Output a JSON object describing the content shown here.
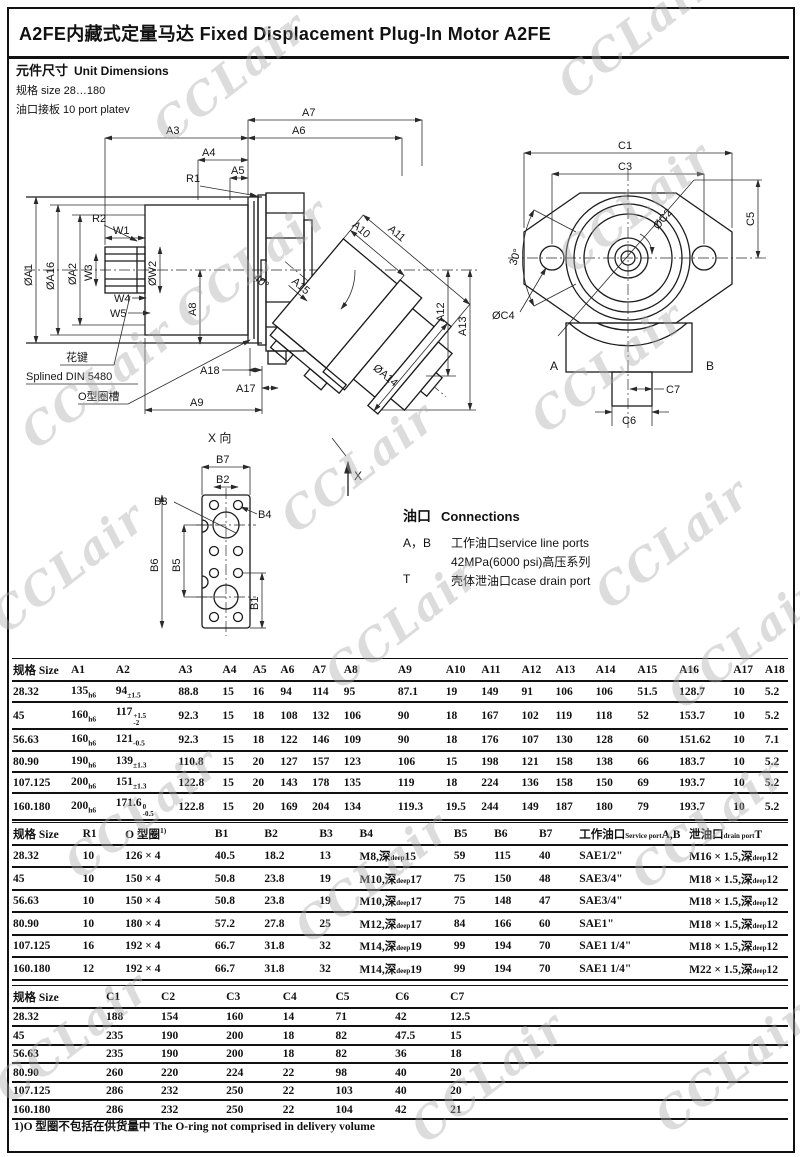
{
  "title": "A2FE内藏式定量马达  Fixed Displacement Plug-In Motor A2FE",
  "section": {
    "heading_zh": "元件尺寸",
    "heading_en": "Unit Dimensions",
    "size_line": "规格 size 28…180",
    "port_line": "油口接板 10 port platev"
  },
  "watermark": {
    "text": "CCLair"
  },
  "connections": {
    "heading_zh": "油口",
    "heading_en": "Connections",
    "rows": [
      {
        "label": "A，B",
        "text": "工作油口service line ports"
      },
      {
        "label": "",
        "text": "42MPa(6000 psi)高压系列"
      },
      {
        "label": "T",
        "text": "壳体泄油口case drain port"
      }
    ]
  },
  "dims": {
    "a3": "A3",
    "a4": "A4",
    "a5": "A5",
    "a6": "A6",
    "a7": "A7",
    "a8": "A8",
    "a9": "A9",
    "a10": "A10",
    "a11": "A11",
    "a12": "A12",
    "a13": "A13",
    "a15": "A15",
    "a17": "A17",
    "a18": "A18",
    "r1": "R1",
    "r2": "R2",
    "w1": "W1",
    "w3": "W3",
    "w4": "W4",
    "w5": "W5",
    "phi_a1": "ØA1",
    "phi_a16": "ØA16",
    "phi_a2": "ØA2",
    "phi_w2": "ØW2",
    "phi_a14": "ØA14",
    "deg40": "40°",
    "spline_zh": "花键",
    "spline_en": "Splined DIN 5480",
    "oring_zh": "O型圈槽",
    "x_label": "X",
    "xview": "X 向",
    "b1": "B1",
    "b2": "B2",
    "b3": "B3",
    "b4": "B4",
    "b5": "B5",
    "b6": "B6",
    "b7": "B7",
    "c1": "C1",
    "c3": "C3",
    "phi_c2": "ØC2",
    "c5": "C5",
    "deg30": "30°",
    "phi_c4": "ØC4",
    "port_a": "A",
    "port_b": "B",
    "c6": "C6",
    "c7": "C7"
  },
  "tables": {
    "t1": {
      "headers": [
        "规格 Size",
        "A1",
        "A2",
        "A3",
        "A4",
        "A5",
        "A6",
        "A7",
        "A8",
        "A9",
        "A10",
        "A11",
        "A12",
        "A13",
        "A14",
        "A15",
        "A16",
        "A17",
        "A18"
      ],
      "rows": [
        [
          "28.32",
          {
            "v": "135",
            "sub": "h6"
          },
          {
            "v": "94",
            "sub": "±1.5"
          },
          "88.8",
          "15",
          "16",
          "94",
          "114",
          "95",
          "87.1",
          "19",
          "149",
          "91",
          "106",
          "106",
          "51.5",
          "128.7",
          "10",
          "5.2"
        ],
        [
          "45",
          {
            "v": "160",
            "sub": "h6"
          },
          {
            "v": "117",
            "sup": "+1.5",
            "sub": "-2"
          },
          "92.3",
          "15",
          "18",
          "108",
          "132",
          "106",
          "90",
          "18",
          "167",
          "102",
          "119",
          "118",
          "52",
          "153.7",
          "10",
          "5.2"
        ],
        [
          "56.63",
          {
            "v": "160",
            "sub": "h6"
          },
          {
            "v": "121",
            "sub": "-0.5"
          },
          "92.3",
          "15",
          "18",
          "122",
          "146",
          "109",
          "90",
          "18",
          "176",
          "107",
          "130",
          "128",
          "60",
          "151.62",
          "10",
          "7.1"
        ],
        [
          "80.90",
          {
            "v": "190",
            "sub": "h6"
          },
          {
            "v": "139",
            "sub": "±1.3"
          },
          "110.8",
          "15",
          "20",
          "127",
          "157",
          "123",
          "106",
          "15",
          "198",
          "121",
          "158",
          "138",
          "66",
          "183.7",
          "10",
          "5.2"
        ],
        [
          "107.125",
          {
            "v": "200",
            "sub": "h6"
          },
          {
            "v": "151",
            "sub": "±1.3"
          },
          "122.8",
          "15",
          "20",
          "143",
          "178",
          "135",
          "119",
          "18",
          "224",
          "136",
          "158",
          "150",
          "69",
          "193.7",
          "10",
          "5.2"
        ],
        [
          "160.180",
          {
            "v": "200",
            "sub": "h6"
          },
          {
            "v": "171.6",
            "sup": "0",
            "sub": "-0.5"
          },
          "122.8",
          "15",
          "20",
          "169",
          "204",
          "134",
          "119.3",
          "19.5",
          "244",
          "149",
          "187",
          "180",
          "79",
          "193.7",
          "10",
          "5.2"
        ]
      ]
    },
    "t2": {
      "headers": [
        "规格 Size",
        "R1",
        {
          "v": "O 型圈",
          "sup": "1)"
        },
        "B1",
        "B2",
        "B3",
        "B4",
        "B5",
        "B6",
        "B7",
        {
          "v": "工作油口",
          "small": "Service port",
          "post": "A,B"
        },
        {
          "v": "泄油口",
          "small": "drain port",
          "post": "T"
        }
      ],
      "rows": [
        [
          "28.32",
          "10",
          "126 × 4",
          "40.5",
          "18.2",
          "13",
          {
            "v": "M8,深",
            "small": "deep",
            "post": "15"
          },
          "59",
          "115",
          "40",
          "SAE1/2\"",
          {
            "v": "M16 × 1.5,深",
            "small": "deep",
            "post": "12"
          }
        ],
        [
          "45",
          "10",
          "150 × 4",
          "50.8",
          "23.8",
          "19",
          {
            "v": "M10,深",
            "small": "deep",
            "post": "17"
          },
          "75",
          "150",
          "48",
          "SAE3/4\"",
          {
            "v": "M18 × 1.5,深",
            "small": "deep",
            "post": "12"
          }
        ],
        [
          "56.63",
          "10",
          "150 × 4",
          "50.8",
          "23.8",
          "19",
          {
            "v": "M10,深",
            "small": "deep",
            "post": "17"
          },
          "75",
          "148",
          "47",
          "SAE3/4\"",
          {
            "v": "M18 × 1.5,深",
            "small": "deep",
            "post": "12"
          }
        ],
        [
          "80.90",
          "10",
          "180 × 4",
          "57.2",
          "27.8",
          "25",
          {
            "v": "M12,深",
            "small": "deep",
            "post": "17"
          },
          "84",
          "166",
          "60",
          "SAE1\"",
          {
            "v": "M18 × 1.5,深",
            "small": "deep",
            "post": "12"
          }
        ],
        [
          "107.125",
          "16",
          "192 × 4",
          "66.7",
          "31.8",
          "32",
          {
            "v": "M14,深",
            "small": "deep",
            "post": "19"
          },
          "99",
          "194",
          "70",
          "SAE1 1/4\"",
          {
            "v": "M18 × 1.5,深",
            "small": "deep",
            "post": "12"
          }
        ],
        [
          "160.180",
          "12",
          "192 × 4",
          "66.7",
          "31.8",
          "32",
          {
            "v": "M14,深",
            "small": "deep",
            "post": "19"
          },
          "99",
          "194",
          "70",
          "SAE1 1/4\"",
          {
            "v": "M22 × 1.5,深",
            "small": "deep",
            "post": "12"
          }
        ]
      ]
    },
    "t3": {
      "headers": [
        "规格 Size",
        "C1",
        "C2",
        "C3",
        "C4",
        "C5",
        "C6",
        "C7"
      ],
      "rows": [
        [
          "28.32",
          "188",
          "154",
          "160",
          "14",
          "71",
          "42",
          "12.5"
        ],
        [
          "45",
          "235",
          "190",
          "200",
          "18",
          "82",
          "47.5",
          "15"
        ],
        [
          "56.63",
          "235",
          "190",
          "200",
          "18",
          "82",
          "36",
          "18"
        ],
        [
          "80.90",
          "260",
          "220",
          "224",
          "22",
          "98",
          "40",
          "20"
        ],
        [
          "107.125",
          "286",
          "232",
          "250",
          "22",
          "103",
          "40",
          "20"
        ],
        [
          "160.180",
          "286",
          "232",
          "250",
          "22",
          "104",
          "42",
          "21"
        ]
      ]
    }
  },
  "footnote": "1)O 型圈不包括在供货量中 The O-ring not comprised in delivery volume"
}
